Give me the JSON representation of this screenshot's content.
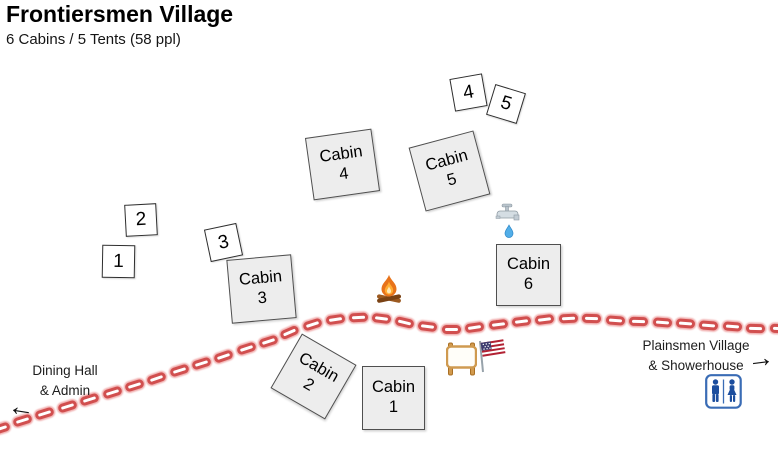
{
  "header": {
    "title": "Frontiersmen Village",
    "subtitle": "6 Cabins / 5 Tents (58 ppl)"
  },
  "colors": {
    "cabin_fill": "#ededed",
    "cabin_border": "#4f4f4f",
    "tent_fill": "#ffffff",
    "tent_border": "#2e2e2e",
    "road_red": "#d14f4f",
    "road_glow": "#ec9696",
    "restroom_blue": "#2d5ca8",
    "text": "#1c1c1c"
  },
  "cabins": [
    {
      "label": "Cabin",
      "number": "1",
      "x": 362,
      "y": 366,
      "w": 61,
      "h": 62,
      "rot": 0
    },
    {
      "label": "Cabin",
      "number": "2",
      "x": 282,
      "y": 345,
      "w": 61,
      "h": 61,
      "rot": 30
    },
    {
      "label": "Cabin",
      "number": "3",
      "x": 229,
      "y": 257,
      "w": 63,
      "h": 62,
      "rot": -5
    },
    {
      "label": "Cabin",
      "number": "4",
      "x": 309,
      "y": 133,
      "w": 65,
      "h": 61,
      "rot": -8
    },
    {
      "label": "Cabin",
      "number": "5",
      "x": 416,
      "y": 138,
      "w": 65,
      "h": 64,
      "rot": -15
    },
    {
      "label": "Cabin",
      "number": "6",
      "x": 496,
      "y": 244,
      "w": 63,
      "h": 60,
      "rot": 0
    }
  ],
  "tents": [
    {
      "number": "1",
      "x": 102,
      "y": 245,
      "s": 31,
      "rot": 1
    },
    {
      "number": "2",
      "x": 125,
      "y": 204,
      "s": 30,
      "rot": -3
    },
    {
      "number": "3",
      "x": 207,
      "y": 226,
      "s": 31,
      "rot": -12
    },
    {
      "number": "4",
      "x": 452,
      "y": 76,
      "s": 31,
      "rot": -10
    },
    {
      "number": "5",
      "x": 490,
      "y": 88,
      "s": 30,
      "rot": 17
    }
  ],
  "road": {
    "points": [
      [
        0,
        428
      ],
      [
        35,
        417
      ],
      [
        70,
        406
      ],
      [
        105,
        395
      ],
      [
        140,
        384
      ],
      [
        175,
        372
      ],
      [
        210,
        361
      ],
      [
        245,
        349
      ],
      [
        270,
        341
      ],
      [
        295,
        330
      ],
      [
        320,
        322
      ],
      [
        348,
        318
      ],
      [
        370,
        317
      ],
      [
        395,
        320
      ],
      [
        420,
        326
      ],
      [
        445,
        329
      ],
      [
        468,
        329
      ],
      [
        495,
        325
      ],
      [
        520,
        322
      ],
      [
        545,
        319
      ],
      [
        570,
        318
      ],
      [
        600,
        319
      ],
      [
        630,
        321
      ],
      [
        660,
        322
      ],
      [
        690,
        324
      ],
      [
        720,
        326
      ],
      [
        750,
        328
      ],
      [
        780,
        329
      ]
    ],
    "dash_w": 19,
    "dash_h": 9,
    "spacing": 23.5
  },
  "labels": {
    "dining_hall": {
      "line1": "Dining Hall",
      "line2": "& Admin"
    },
    "plainsmen": {
      "line1": "Plainsmen Village",
      "line2": "& Showerhouse"
    }
  },
  "glyphs": {
    "arrow_left": "←",
    "arrow_right": "→"
  },
  "icons": {
    "campfire": "campfire-icon",
    "water_tap": "water-tap-icon",
    "signboard": "blank-signboard-icon",
    "us_flag": "us-flag-icon",
    "restroom": "restroom-icon",
    "arrow_left": "left-arrow-icon",
    "arrow_right": "right-arrow-icon"
  }
}
